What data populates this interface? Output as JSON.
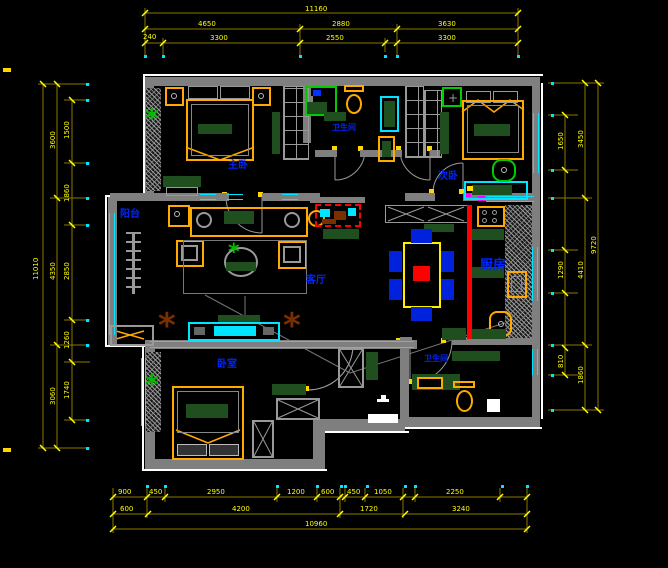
{
  "title": "apartment-floor-plan",
  "colors": {
    "wall": "#7f7f7f",
    "outline": "#ffffff",
    "dimension": "#ffff00",
    "window_glass": "#00e5ff",
    "room_label": "#0026ff",
    "furniture_wood": "#ffaa00",
    "cushion_green": "#1f4f1f",
    "accent_red": "#ff0000",
    "chair_blue": "#0022dd",
    "plant_green": "#00bb00",
    "plant_brown": "#7a2f00"
  },
  "rooms": {
    "master_bedroom": "主卧",
    "bathroom1": "卫生间",
    "bedroom2": "次卧",
    "balcony": "阳台",
    "living_room": "客厅",
    "kitchen": "厨房",
    "bathroom2": "卫生间",
    "bedroom3": "卧室"
  },
  "icons": {
    "plant": "*",
    "flower": "+"
  },
  "dims": {
    "top": {
      "overall": "11160",
      "row2": [
        "4650",
        "2880",
        "3630"
      ],
      "row3": [
        "240",
        "3300",
        "2550",
        "3300"
      ]
    },
    "bottom": {
      "row1": [
        "900",
        "450",
        "2950",
        "1200",
        "600",
        "450",
        "1050",
        "2250"
      ],
      "row2": [
        "600",
        "4200",
        "1720",
        "3240"
      ],
      "overall": "10960"
    },
    "left": {
      "short": [
        "1500",
        "1860",
        "2850",
        "1260",
        "1740"
      ],
      "inner": [
        "3600",
        "4350",
        "3060"
      ],
      "overall": "11010"
    },
    "right": {
      "short": [
        "1650",
        "1290",
        "810"
      ],
      "inner": [
        "3450",
        "4410",
        "1860"
      ],
      "overall": "9720"
    }
  }
}
